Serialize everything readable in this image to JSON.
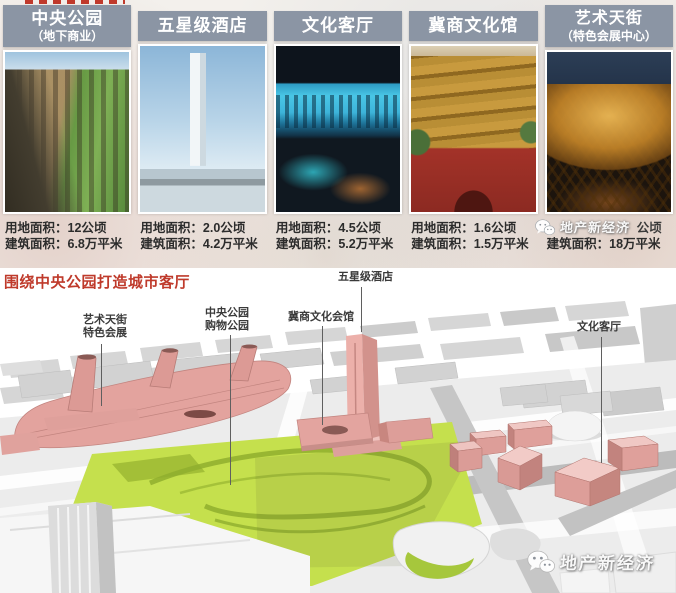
{
  "top_section": {
    "columns": [
      {
        "header": [
          "中央公园",
          "（地下商业）"
        ],
        "stats": [
          "用地面积：12公顷",
          "建筑面积：6.8万平米"
        ]
      },
      {
        "header": [
          "五星级酒店"
        ],
        "stats": [
          "用地面积：2.0公顷",
          "建筑面积：4.2万平米"
        ]
      },
      {
        "header": [
          "文化客厅"
        ],
        "stats": [
          "用地面积：4.5公顷",
          "建筑面积：5.2万平米"
        ]
      },
      {
        "header": [
          "冀商文化馆"
        ],
        "stats": [
          "用地面积：1.6公顷",
          "建筑面积：1.5万平米"
        ]
      },
      {
        "header": [
          "艺术天街",
          "（特色会展中心）"
        ],
        "stats_peek": "公顷",
        "stats": [
          "建筑面积：18万平米"
        ]
      }
    ]
  },
  "bottom_section": {
    "title": "围绕中央公园打造城市客厅",
    "labels": {
      "art_street": [
        "艺术天街",
        "特色会展"
      ],
      "central_park": [
        "中央公园",
        "购物公园"
      ],
      "jishang": [
        "冀商文化会馆"
      ],
      "hotel": [
        "五星级酒店"
      ],
      "culture_hall": [
        "文化客厅"
      ]
    }
  },
  "watermark": {
    "text": "地产新经济"
  },
  "colors": {
    "header_bg": "#8b95a4",
    "title_red": "#bf3a2b",
    "park_green": "#c5e04d",
    "building_pink": "#e3a39e",
    "ground_gray": "#ececec"
  }
}
